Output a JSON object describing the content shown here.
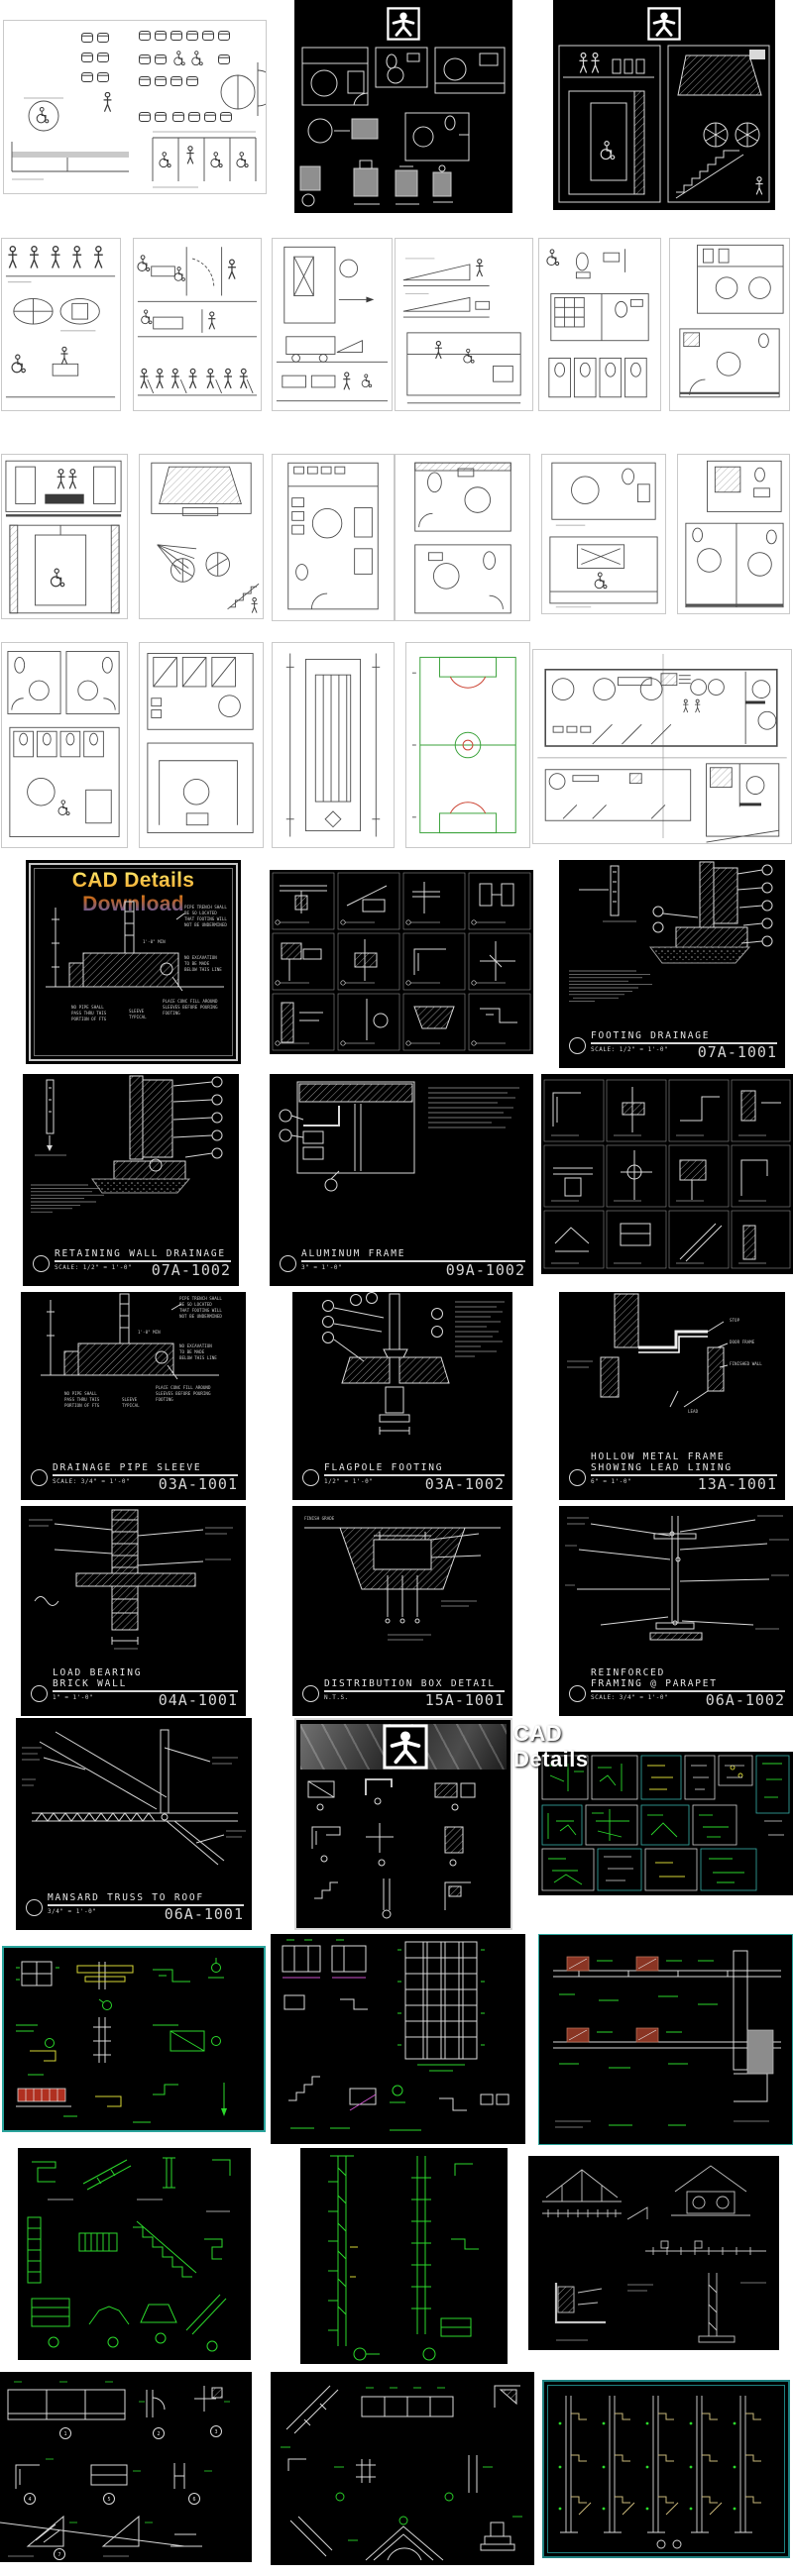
{
  "covers": {
    "accessibility": "Accessibility Facilities",
    "cad_details": "CAD Details",
    "cad_details_download": "CAD Details Download"
  },
  "sheets": {
    "footing_drainage": {
      "t1": "FOOTING DRAINAGE",
      "t2": "",
      "scale": "SCALE: 1/2\" = 1'-0\"",
      "num": "07A-1001"
    },
    "retaining_wall": {
      "t1": "RETAINING WALL DRAINAGE",
      "t2": "",
      "scale": "SCALE: 1/2\" = 1'-0\"",
      "num": "07A-1002"
    },
    "aluminum_frame": {
      "t1": "ALUMINUM FRAME",
      "t2": "",
      "scale": "3\" = 1'-0\"",
      "num": "09A-1002"
    },
    "drainage_sleeve": {
      "t1": "DRAINAGE PIPE SLEEVE",
      "t2": "",
      "scale": "SCALE: 3/4\" = 1'-0\"",
      "num": "03A-1001"
    },
    "flagpole": {
      "t1": "FLAGPOLE FOOTING",
      "t2": "",
      "scale": "1/2\" = 1'-0\"",
      "num": "03A-1002"
    },
    "hollow_metal": {
      "t1": "HOLLOW METAL FRAME",
      "t2": "SHOWING LEAD LINING",
      "scale": "6\" = 1'-0\"",
      "num": "13A-1001"
    },
    "load_bearing": {
      "t1": "LOAD BEARING",
      "t2": "BRICK WALL",
      "scale": "1\" = 1'-0\"",
      "num": "04A-1001"
    },
    "distribution_box": {
      "t1": "DISTRIBUTION BOX DETAIL",
      "t2": "",
      "scale": "N.T.S.",
      "num": "15A-1001"
    },
    "reinforced_framing": {
      "t1": "REINFORCED",
      "t2": "FRAMING @ PARAPET",
      "scale": "SCALE: 3/4\" = 1'-0\"",
      "num": "06A-1002"
    },
    "mansard": {
      "t1": "MANSARD TRUSS TO ROOF",
      "t2": "",
      "scale": "3/4\" = 1'-0\"",
      "num": "06A-1001"
    }
  },
  "notes": {
    "sleeve1": [
      "PIPE TRENCH SHALL",
      "BE SO LOCATED",
      "THAT FOOTING WILL",
      "NOT BE UNDERMINED"
    ],
    "sleeve2": [
      "NO EXCAVATION",
      "TO BE MADE",
      "BELOW THIS LINE"
    ],
    "sleeve3": [
      "NO PIPE SHALL",
      "PASS THRU THIS",
      "PORTION OF FTG"
    ],
    "sleeve4": [
      "PLACE CONC FILL AROUND",
      "SLEEVES BEFORE POURING",
      "FOOTING"
    ],
    "sleeve5": [
      "SLEEVE",
      "TYPICAL"
    ],
    "min_dim": "1'-0\" MIN",
    "hollow": [
      "STOP",
      "DOOR FRAME",
      "FINISHED WALL",
      "LEAD"
    ],
    "dist": [
      "FINISH GRADE"
    ]
  },
  "r12p1": {
    "indices": [
      "1",
      "2",
      "3",
      "4",
      "5",
      "6",
      "7"
    ]
  }
}
